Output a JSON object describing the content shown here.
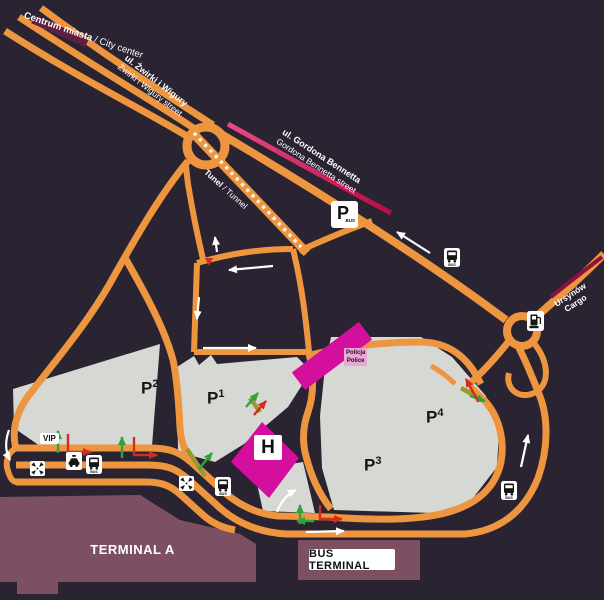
{
  "colors": {
    "bg": "#2a2331",
    "road": "#ee9540",
    "gray": "#d6d9d3",
    "magenta": "#d40f9e",
    "terminal": "#7d4f63",
    "crimson": "#d01154",
    "maroon-road": "#5e2040",
    "green": "#2ea33b",
    "red": "#d32b20"
  },
  "streets": {
    "city_center": {
      "bold": "Centrum miasta",
      "rest": " / City center"
    },
    "zwirki": {
      "line1": "ul. Żwirki i Wigury",
      "line2": "Żwirki i Wigury street"
    },
    "bennetta": {
      "line1": "ul. Gordona Bennetta",
      "line2": "Gordona Bennetta street"
    },
    "tunnel": {
      "bold": "Tunel",
      "rest": " / Tunnel"
    },
    "ursynow": {
      "line1": "Ursynów",
      "line2": "Cargo"
    }
  },
  "parking": {
    "p1": {
      "base": "P",
      "sup": "1"
    },
    "p2": {
      "base": "P",
      "sup": "2"
    },
    "p3": {
      "base": "P",
      "sup": "3"
    },
    "p4": {
      "base": "P",
      "sup": "4"
    },
    "bus_parking": {
      "p": "P",
      "sub": "BUS"
    }
  },
  "buildings": {
    "terminal_a": "TERMINAL A",
    "bus_terminal": "BUS TERMINAL",
    "hotel": "H",
    "police": {
      "line1": "Policja",
      "line2": "Police"
    },
    "vip": "VIP"
  },
  "icons": {
    "bus_stop": "BUS",
    "names": {
      "bus_stop": "bus-stop-icon",
      "meeting_point": "meeting-point-icon",
      "taxi": "taxi-icon",
      "fuel": "fuel-station-icon"
    }
  }
}
